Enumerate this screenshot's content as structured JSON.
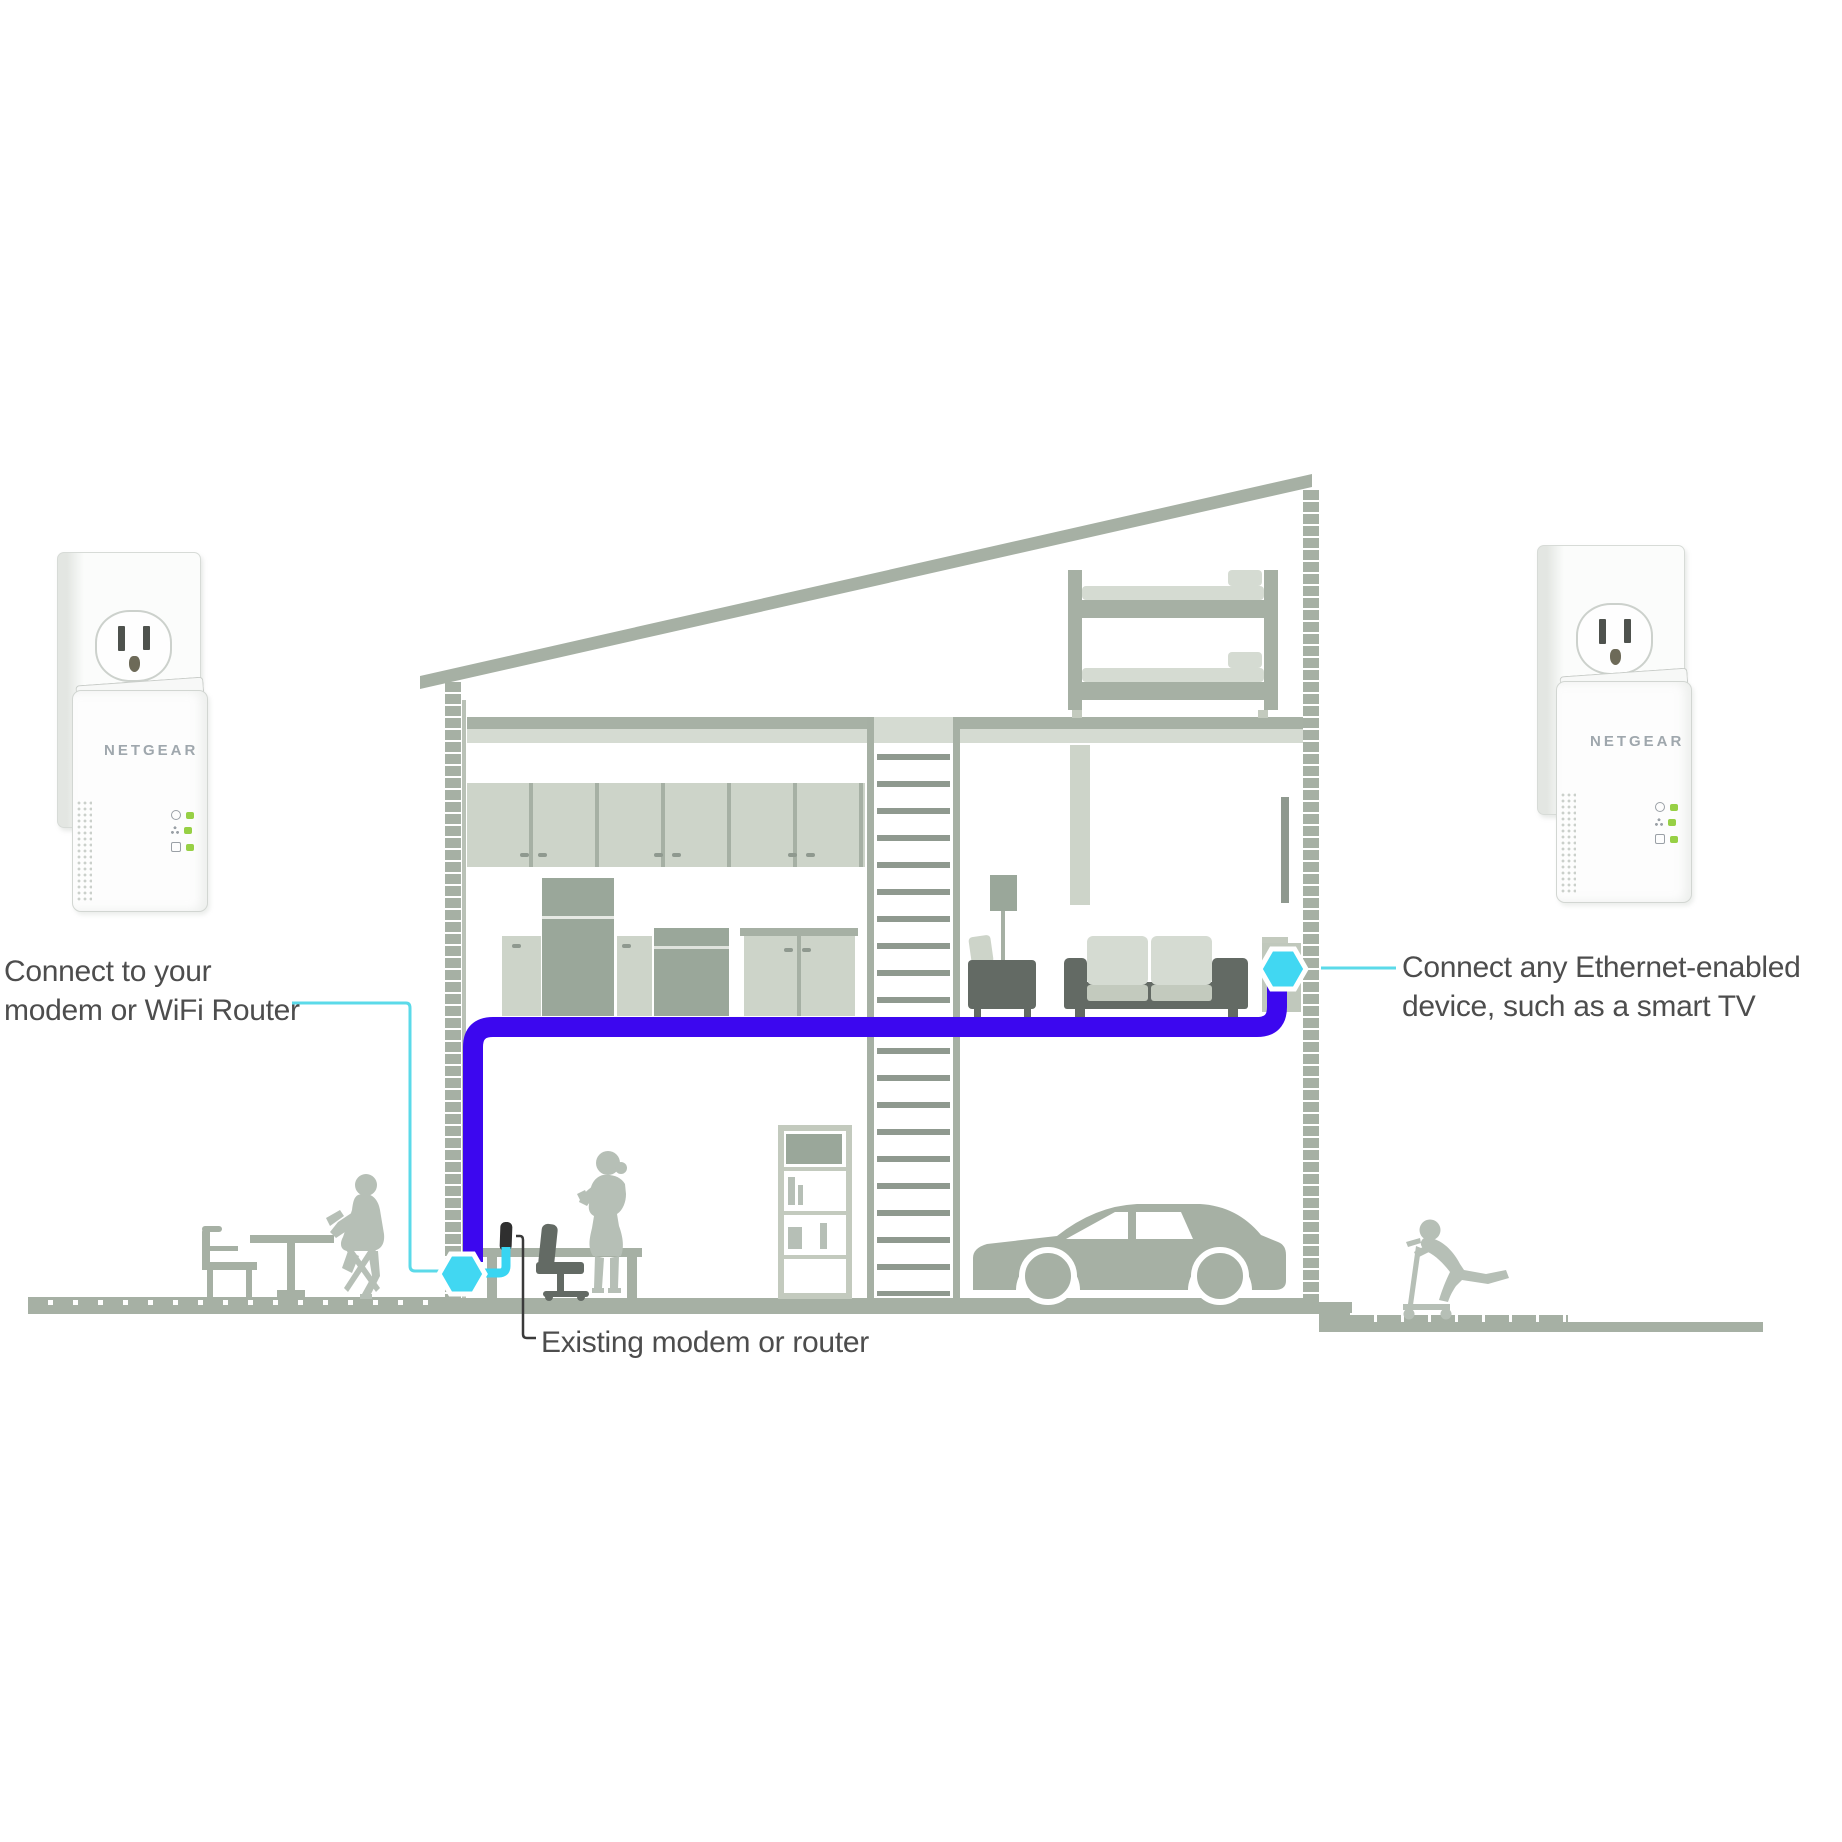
{
  "labels": {
    "left": {
      "line1": "Connect to your",
      "line2": "modem or WiFi Router"
    },
    "right": {
      "line1": "Connect any Ethernet-enabled",
      "line2": "device, such as a smart TV"
    },
    "bottom": {
      "text": "Existing modem or router"
    }
  },
  "adapters": {
    "left": {
      "logo": "NETGEAR",
      "leds": [
        "power-led",
        "pick-a-plug-led",
        "ethernet-led"
      ]
    },
    "right": {
      "logo": "NETGEAR",
      "leds": [
        "power-led",
        "pick-a-plug-led",
        "ethernet-led"
      ]
    }
  },
  "icons": {
    "connection_marker": "cyan-hexagon-icon",
    "outlet": "power-outlet-icon"
  },
  "colors": {
    "cable_blue": "#3c07ef",
    "connector_cyan": "#41d7f2",
    "annotation_cyan": "#5bdae9",
    "structure_gray_green": "#a6b0a4",
    "panel_light": "#cdd4c9",
    "furniture_dark": "#636a64",
    "silhouette_gray": "#b6bfb6",
    "led_green": "#97d045",
    "logo_gray": "#9fa7ad",
    "text_gray": "#4d4d4d"
  }
}
